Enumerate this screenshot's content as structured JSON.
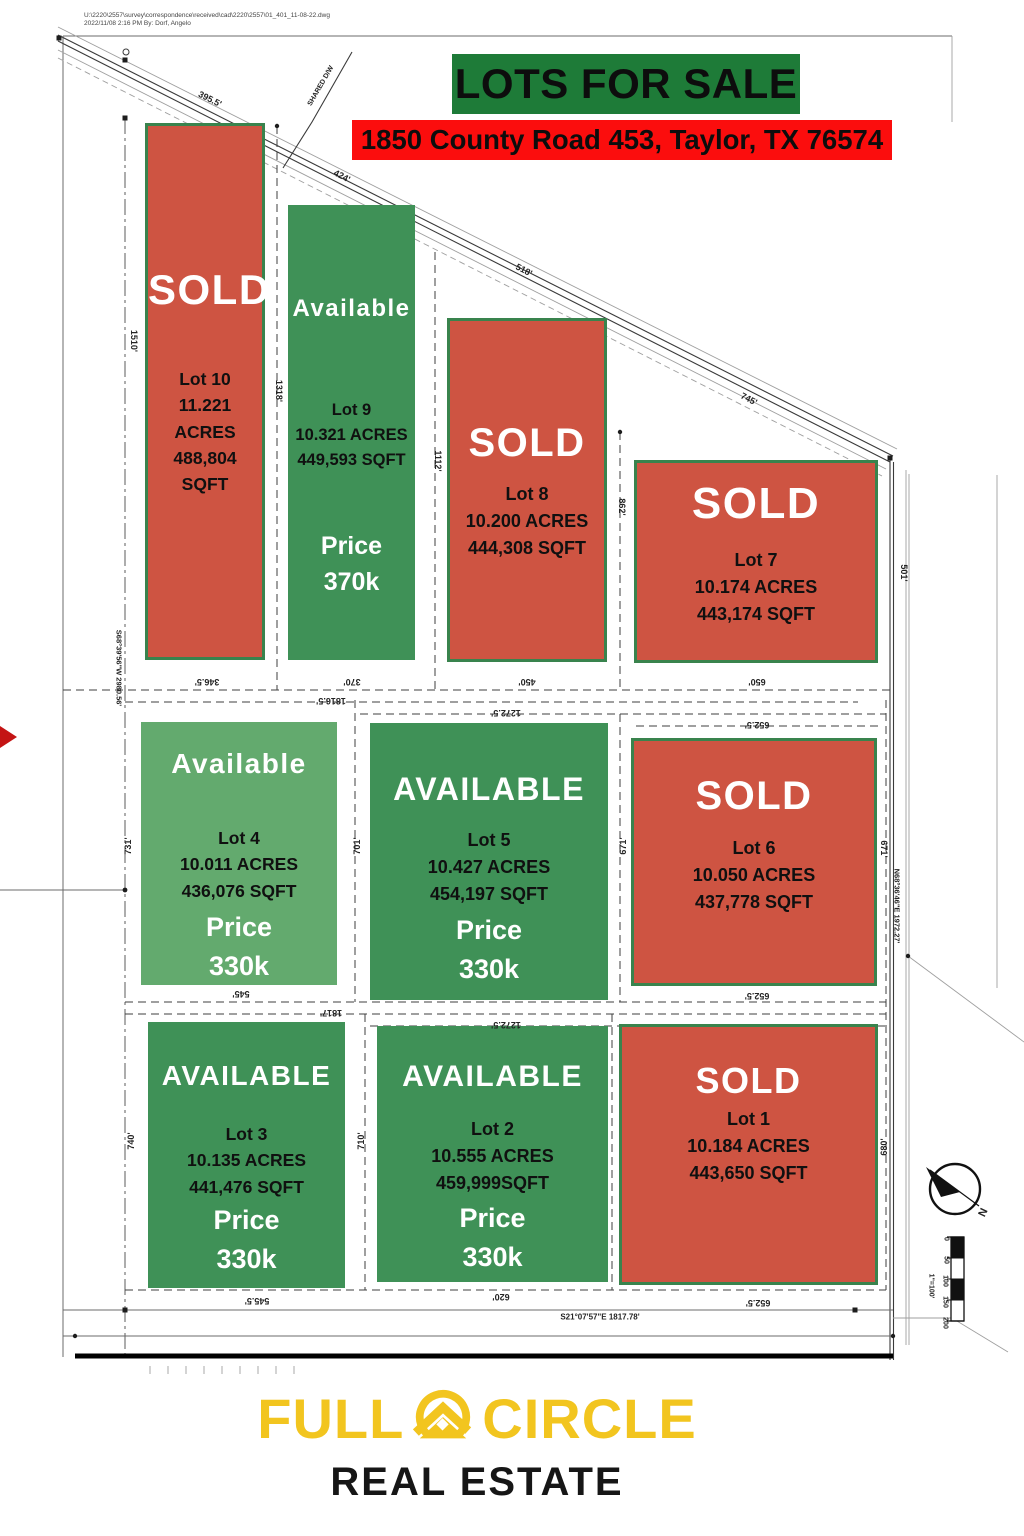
{
  "meta": {
    "file_line1": "U:\\2220\\2557\\survey\\correspondence\\received\\cad\\2220\\2557\\01_401_11-08-22.dwg",
    "file_line2": "2022/11/08 2:16 PM By: Dorf, Angelo"
  },
  "header": {
    "title": "LOTS FOR SALE",
    "address": "1850 County Road 453, Taylor, TX 76574"
  },
  "colors": {
    "sold_lot": "#ce5442",
    "available_lot": "#3f9157",
    "available_lot_light": "#63aa6e",
    "title_bg": "#1e7b38",
    "address_bg": "#fb0d0d",
    "logo_yellow": "#f2c51f"
  },
  "lots": [
    {
      "id": 10,
      "status": "SOLD",
      "name": "Lot 10",
      "acres": "11.221 ACRES",
      "sqft": "488,804 SQFT"
    },
    {
      "id": 9,
      "status": "Available",
      "name": "Lot 9",
      "acres": "10.321 ACRES",
      "sqft": "449,593 SQFT",
      "price_label": "Price",
      "price": "370k"
    },
    {
      "id": 8,
      "status": "SOLD",
      "name": "Lot 8",
      "acres": "10.200 ACRES",
      "sqft": "444,308 SQFT"
    },
    {
      "id": 7,
      "status": "SOLD",
      "name": "Lot 7",
      "acres": "10.174 ACRES",
      "sqft": "443,174  SQFT"
    },
    {
      "id": 4,
      "status": "Available",
      "name": "Lot 4",
      "acres": "10.011 ACRES",
      "sqft": "436,076 SQFT",
      "price_label": "Price",
      "price": "330k",
      "variant": "light"
    },
    {
      "id": 5,
      "status": "AVAILABLE",
      "name": "Lot 5",
      "acres": "10.427 ACRES",
      "sqft": "454,197 SQFT",
      "price_label": "Price",
      "price": "330k"
    },
    {
      "id": 6,
      "status": "SOLD",
      "name": "Lot 6",
      "acres": "10.050 ACRES",
      "sqft": "437,778 SQFT"
    },
    {
      "id": 3,
      "status": "AVAILABLE",
      "name": "Lot 3",
      "acres": "10.135 ACRES",
      "sqft": "441,476 SQFT",
      "price_label": "Price",
      "price": "330k"
    },
    {
      "id": 2,
      "status": "AVAILABLE",
      "name": "Lot 2",
      "acres": "10.555 ACRES",
      "sqft": "459,999SQFT",
      "price_label": "Price",
      "price": "330k"
    },
    {
      "id": 1,
      "status": "SOLD",
      "name": "Lot 1",
      "acres": "10.184 ACRES",
      "sqft": "443,650 SQFT"
    }
  ],
  "dimensions": [
    {
      "text": "395.5'",
      "x": 210,
      "y": 99,
      "rot": 27,
      "s": 9
    },
    {
      "text": "424'",
      "x": 342,
      "y": 176,
      "rot": 27,
      "s": 9
    },
    {
      "text": "518'",
      "x": 524,
      "y": 270,
      "rot": 27,
      "s": 9
    },
    {
      "text": "745'",
      "x": 749,
      "y": 399,
      "rot": 27,
      "s": 9
    },
    {
      "text": "SHARED D/W",
      "x": 321,
      "y": 86,
      "rot": -60,
      "s": 7
    },
    {
      "text": "1510'",
      "x": 134,
      "y": 341,
      "rot": 90,
      "s": 9
    },
    {
      "text": "1318'",
      "x": 279,
      "y": 391,
      "rot": 90,
      "s": 9
    },
    {
      "text": "1112'",
      "x": 438,
      "y": 461,
      "rot": 90,
      "s": 9
    },
    {
      "text": "862'",
      "x": 622,
      "y": 507,
      "rot": 90,
      "s": 9
    },
    {
      "text": "501'",
      "x": 904,
      "y": 573,
      "rot": 90,
      "s": 9
    },
    {
      "text": "S68°39'56\"W  2980.56'",
      "x": 119,
      "y": 668,
      "rot": 90,
      "s": 7.5
    },
    {
      "text": "346.5'",
      "x": 207,
      "y": 682,
      "rot": 180,
      "s": 9
    },
    {
      "text": "370'",
      "x": 352,
      "y": 682,
      "rot": 180,
      "s": 9
    },
    {
      "text": "450'",
      "x": 527,
      "y": 682,
      "rot": 180,
      "s": 9
    },
    {
      "text": "650'",
      "x": 757,
      "y": 682,
      "rot": 180,
      "s": 9
    },
    {
      "text": "1816.5'",
      "x": 331,
      "y": 701,
      "rot": 180,
      "s": 9
    },
    {
      "text": "1272.5'",
      "x": 506,
      "y": 713,
      "rot": 180,
      "s": 9
    },
    {
      "text": "652.5'",
      "x": 757,
      "y": 725,
      "rot": 180,
      "s": 9
    },
    {
      "text": "731'",
      "x": 128,
      "y": 846,
      "rot": -90,
      "s": 9
    },
    {
      "text": "701'",
      "x": 357,
      "y": 846,
      "rot": -90,
      "s": 9
    },
    {
      "text": "671'",
      "x": 623,
      "y": 846,
      "rot": -90,
      "s": 9
    },
    {
      "text": "671'",
      "x": 884,
      "y": 849,
      "rot": 90,
      "s": 9
    },
    {
      "text": "N68°36'46\"E  1972.27'",
      "x": 897,
      "y": 906,
      "rot": 90,
      "s": 7.5
    },
    {
      "text": "545'",
      "x": 241,
      "y": 994,
      "rot": 180,
      "s": 9
    },
    {
      "text": "652.5'",
      "x": 757,
      "y": 996,
      "rot": 180,
      "s": 9
    },
    {
      "text": "1817'",
      "x": 331,
      "y": 1013,
      "rot": 180,
      "s": 9
    },
    {
      "text": "1272.5'",
      "x": 506,
      "y": 1025,
      "rot": 180,
      "s": 9
    },
    {
      "text": "740'",
      "x": 131,
      "y": 1141,
      "rot": -90,
      "s": 9
    },
    {
      "text": "710'",
      "x": 361,
      "y": 1141,
      "rot": -90,
      "s": 9
    },
    {
      "text": "680'",
      "x": 884,
      "y": 1147,
      "rot": -90,
      "s": 9
    },
    {
      "text": "545.5'",
      "x": 257,
      "y": 1301,
      "rot": 180,
      "s": 9
    },
    {
      "text": "620'",
      "x": 501,
      "y": 1297,
      "rot": 180,
      "s": 9
    },
    {
      "text": "652.5'",
      "x": 758,
      "y": 1303,
      "rot": 180,
      "s": 9
    },
    {
      "text": "S21°07'57\"E  1817.78'",
      "x": 600,
      "y": 1317,
      "rot": 0,
      "s": 8
    }
  ],
  "compass": {
    "north_label": {
      "text": "N",
      "x": 982,
      "y": 1212,
      "rot": 115,
      "s": 11
    }
  },
  "scale_bar": {
    "ticks": [
      {
        "text": "0",
        "x": 946,
        "y": 1239,
        "rot": 90,
        "s": 7
      },
      {
        "text": "50",
        "x": 946,
        "y": 1260,
        "rot": 90,
        "s": 7
      },
      {
        "text": "100",
        "x": 945,
        "y": 1281,
        "rot": 90,
        "s": 7
      },
      {
        "text": "150",
        "x": 945,
        "y": 1302,
        "rot": 90,
        "s": 7
      },
      {
        "text": "200",
        "x": 945,
        "y": 1323,
        "rot": 90,
        "s": 7
      }
    ],
    "ratio": {
      "text": "1\"=100'",
      "x": 931,
      "y": 1286,
      "rot": 90,
      "s": 7
    }
  },
  "footer": {
    "brand_left": "FULL",
    "brand_right": "CIRCLE",
    "brand_sub": "REAL ESTATE"
  }
}
